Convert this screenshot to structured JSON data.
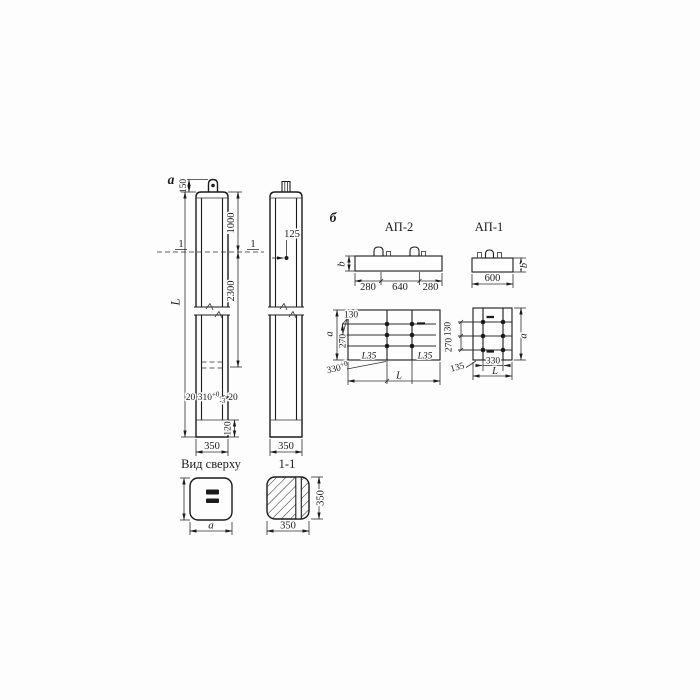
{
  "colors": {
    "ink": "#1b1b1b",
    "paper": "#fdfdfd"
  },
  "figure_a": {
    "marker": "а",
    "front": {
      "dim_150": "150",
      "dim_1000": "1000",
      "dim_2300": "2300",
      "dim_L": "L",
      "section_mark": "1",
      "dim_20_left": "20",
      "dim_310": "310",
      "dim_310_tol_up": "+0",
      "dim_310_tol_down": "-3",
      "dim_20_right": "20",
      "dim_120": "120",
      "dim_350": "350"
    },
    "side": {
      "dim_125": "125",
      "dim_350": "350",
      "section_mark": "1"
    },
    "top_view": {
      "title": "Вид сверху",
      "dim_a": "а"
    },
    "section": {
      "title": "1-1",
      "dim_350_bottom": "350",
      "dim_350_right": "350"
    }
  },
  "figure_b": {
    "marker": "б",
    "ap2": {
      "title": "АП-2",
      "dim_b": "b",
      "dim_280_left": "280",
      "dim_640": "640",
      "dim_280_right": "280",
      "plan": {
        "dim_130": "130",
        "dim_a": "a",
        "dim_270": "270",
        "angle_left": "L35",
        "angle_right": "L35",
        "dim_330": "330",
        "dim_330_tol": "+0",
        "dim_L": "L"
      }
    },
    "ap1": {
      "title": "АП-1",
      "dim_600": "600",
      "dim_b": "b",
      "plan": {
        "dim_130": "130",
        "dim_270": "270",
        "dim_135": "135",
        "dim_330": "330",
        "dim_L": "L",
        "dim_a": "a"
      }
    }
  }
}
